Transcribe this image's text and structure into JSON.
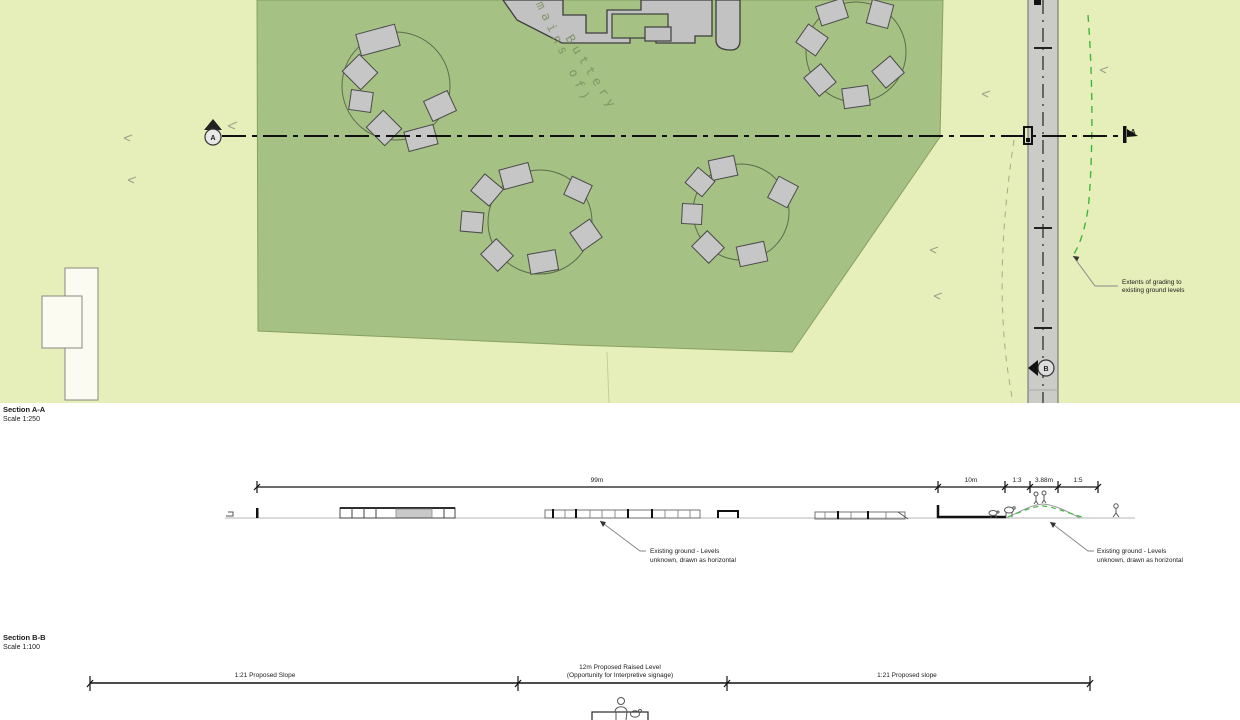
{
  "plan": {
    "buttery_label": "Buttery",
    "remains_label": "(remains of)",
    "grading_note": {
      "line1": "Extents of grading to",
      "line2": "existing ground levels"
    },
    "marker_a": "A",
    "marker_b": "B",
    "colors": {
      "bg_green": "#e6eeba",
      "site_green": "#a6c184",
      "road_gray": "#cbcbc8",
      "grading_dash": "#3cb83c"
    }
  },
  "section_aa": {
    "title": "Section A-A",
    "scale": "Scale 1:250",
    "dims": [
      "99m",
      "10m",
      "1:3",
      "3.88m",
      "1:5"
    ],
    "ground_note": {
      "line1": "Existing ground - Levels",
      "line2": "unknown, drawn as horizontal"
    }
  },
  "section_bb": {
    "title": "Section B-B",
    "scale": "Scale 1:100",
    "dim_left": "1:21 Proposed Slope",
    "dim_mid_line1": "12m Proposed Raised Level",
    "dim_mid_line2": "(Opportunity for Interpretive signage)",
    "dim_right": "1:21 Proposed slope"
  }
}
